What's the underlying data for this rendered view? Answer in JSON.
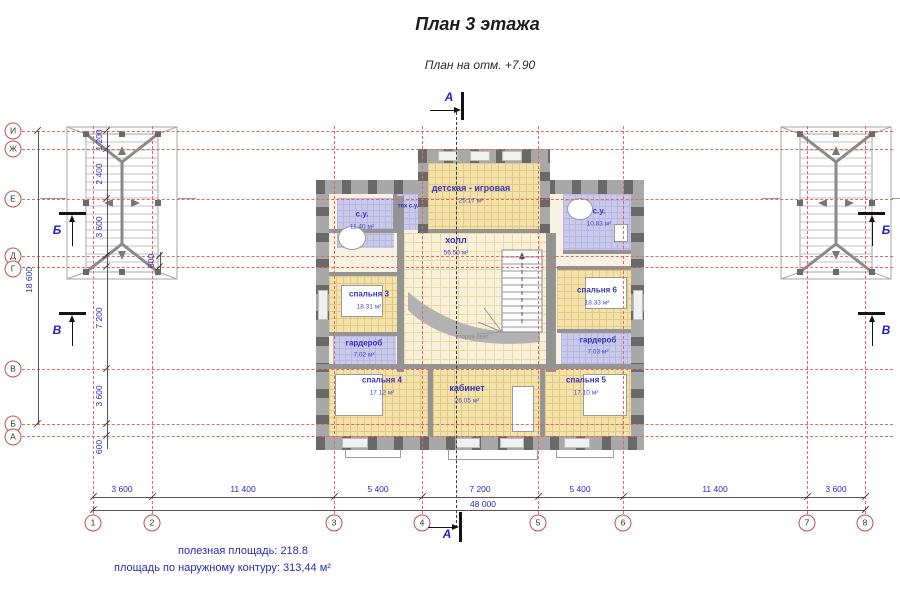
{
  "title": "План 3 этажа",
  "subtitle": "План на отм. +7.90",
  "rooms": [
    {
      "name": "детская - игровая",
      "area": "25.17 м²"
    },
    {
      "name": "с.у.",
      "area": "11.40 м²"
    },
    {
      "name": "тех с.у.",
      "area": ""
    },
    {
      "name": "с.у.",
      "area": "10.83 м²"
    },
    {
      "name": "холл",
      "area": "56.50 м²"
    },
    {
      "name": "спальня 3",
      "area": "18.31 м²"
    },
    {
      "name": "гардероб",
      "area": "7.02 м²"
    },
    {
      "name": "спальня 6",
      "area": "18.33 м²"
    },
    {
      "name": "гардероб",
      "area": "7.03 м²"
    },
    {
      "name": "спальня 4",
      "area": "17.12 м²"
    },
    {
      "name": "кабинет",
      "area": "26.05 м²"
    },
    {
      "name": "спальня 5",
      "area": "17.10 м²"
    },
    {
      "name": "второй свет",
      "area": ""
    }
  ],
  "axes": {
    "horizontal": [
      "И",
      "Ж",
      "Е",
      "Д",
      "Г",
      "В",
      "Б",
      "А"
    ],
    "vertical": [
      "1",
      "2",
      "3",
      "4",
      "5",
      "6",
      "7",
      "8"
    ]
  },
  "sections": {
    "a": "А",
    "b": "Б",
    "v": "В"
  },
  "dims": {
    "bottom": [
      "3 600",
      "11 400",
      "5 400",
      "7 200",
      "5 400",
      "11 400",
      "3 600"
    ],
    "bottom_total": "48 000",
    "left": [
      "1 200",
      "2 400",
      "3 600",
      "7 200",
      "3 600",
      "600"
    ],
    "left_total": "18 600",
    "inner": "600"
  },
  "footer": {
    "line1_label": "полезная площадь:",
    "line1_value": "218.8",
    "line2_label": "площадь по наружному контуру:",
    "line2_value": "313,44 м²"
  }
}
